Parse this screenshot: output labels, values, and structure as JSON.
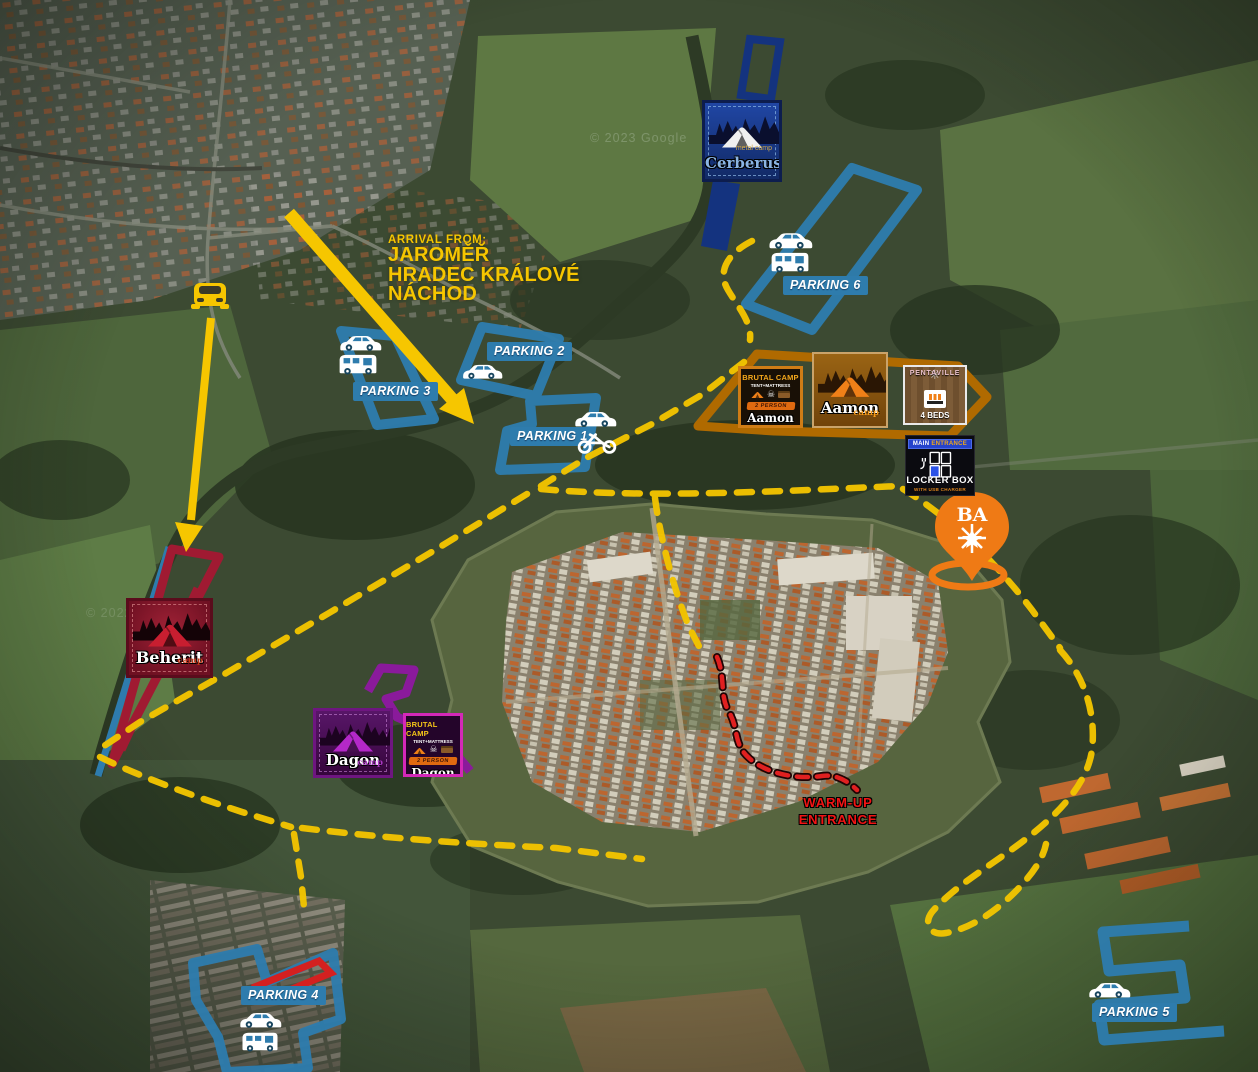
{
  "arrival": {
    "label": "ARRIVAL FROM:",
    "city1": "JAROMĚŘ",
    "city2": "HRADEC KRÁLOVÉ",
    "city3": "NÁCHOD"
  },
  "parkings": {
    "p1": {
      "label": "PARKING 1",
      "icons": [
        "car-icon",
        "motorcycle-icon"
      ]
    },
    "p2": {
      "label": "PARKING 2",
      "icons": [
        "car-icon"
      ]
    },
    "p3": {
      "label": "PARKING 3",
      "icons": [
        "car-icon",
        "camper-icon"
      ]
    },
    "p4": {
      "label": "PARKING 4",
      "icons": [
        "car-icon",
        "camper-icon"
      ]
    },
    "p5": {
      "label": "PARKING 5",
      "icons": [
        "car-icon"
      ]
    },
    "p6": {
      "label": "PARKING 6",
      "icons": [
        "car-icon",
        "camper-icon"
      ]
    }
  },
  "camps": {
    "cerberus": {
      "sub": "metal camp",
      "name": "Cerberus"
    },
    "aamon_brutal": {
      "line1": "BRUTAL CAMP",
      "line2": "TENT+MATTRESS",
      "ribbon": "2 PERSON",
      "name": "Aamon"
    },
    "aamon": {
      "name": "Aamon",
      "sub": "camp"
    },
    "pentaville": {
      "ornament": "✳",
      "name": "PENTAVILLE",
      "beds": "4 BEDS"
    },
    "beherit": {
      "name": "Beherit",
      "sub": "camp"
    },
    "dagon": {
      "name": "Dagon",
      "sub": "camp"
    },
    "dagon_brutal": {
      "line1": "BRUTAL CAMP",
      "line2": "TENT+MATTRESS",
      "ribbon": "2 PERSON",
      "name": "Dagon"
    }
  },
  "locker": {
    "banner_main": "MAIN",
    "banner_entrance": "ENTRANCE",
    "title": "LOCKER BOX",
    "sub": "WITH USB CHARGER"
  },
  "warmup": {
    "line1": "WARM-UP",
    "line2": "ENTRANCE"
  },
  "pin": {
    "letters": "BA"
  },
  "watermarks": {
    "w1": "© 2023 Google",
    "w2": "© 2022"
  },
  "colors": {
    "parking_blue": "#2e7cad",
    "route_yellow": "#f2c400",
    "arrival_yellow": "#f6c600",
    "warmup_red": "#e02020",
    "cerberus_navy": "#14337f",
    "aamon_orange": "#b06a00",
    "beherit_red": "#a01a32",
    "dagon_purple": "#8a1a9b",
    "pin_orange": "#ef7a15"
  }
}
